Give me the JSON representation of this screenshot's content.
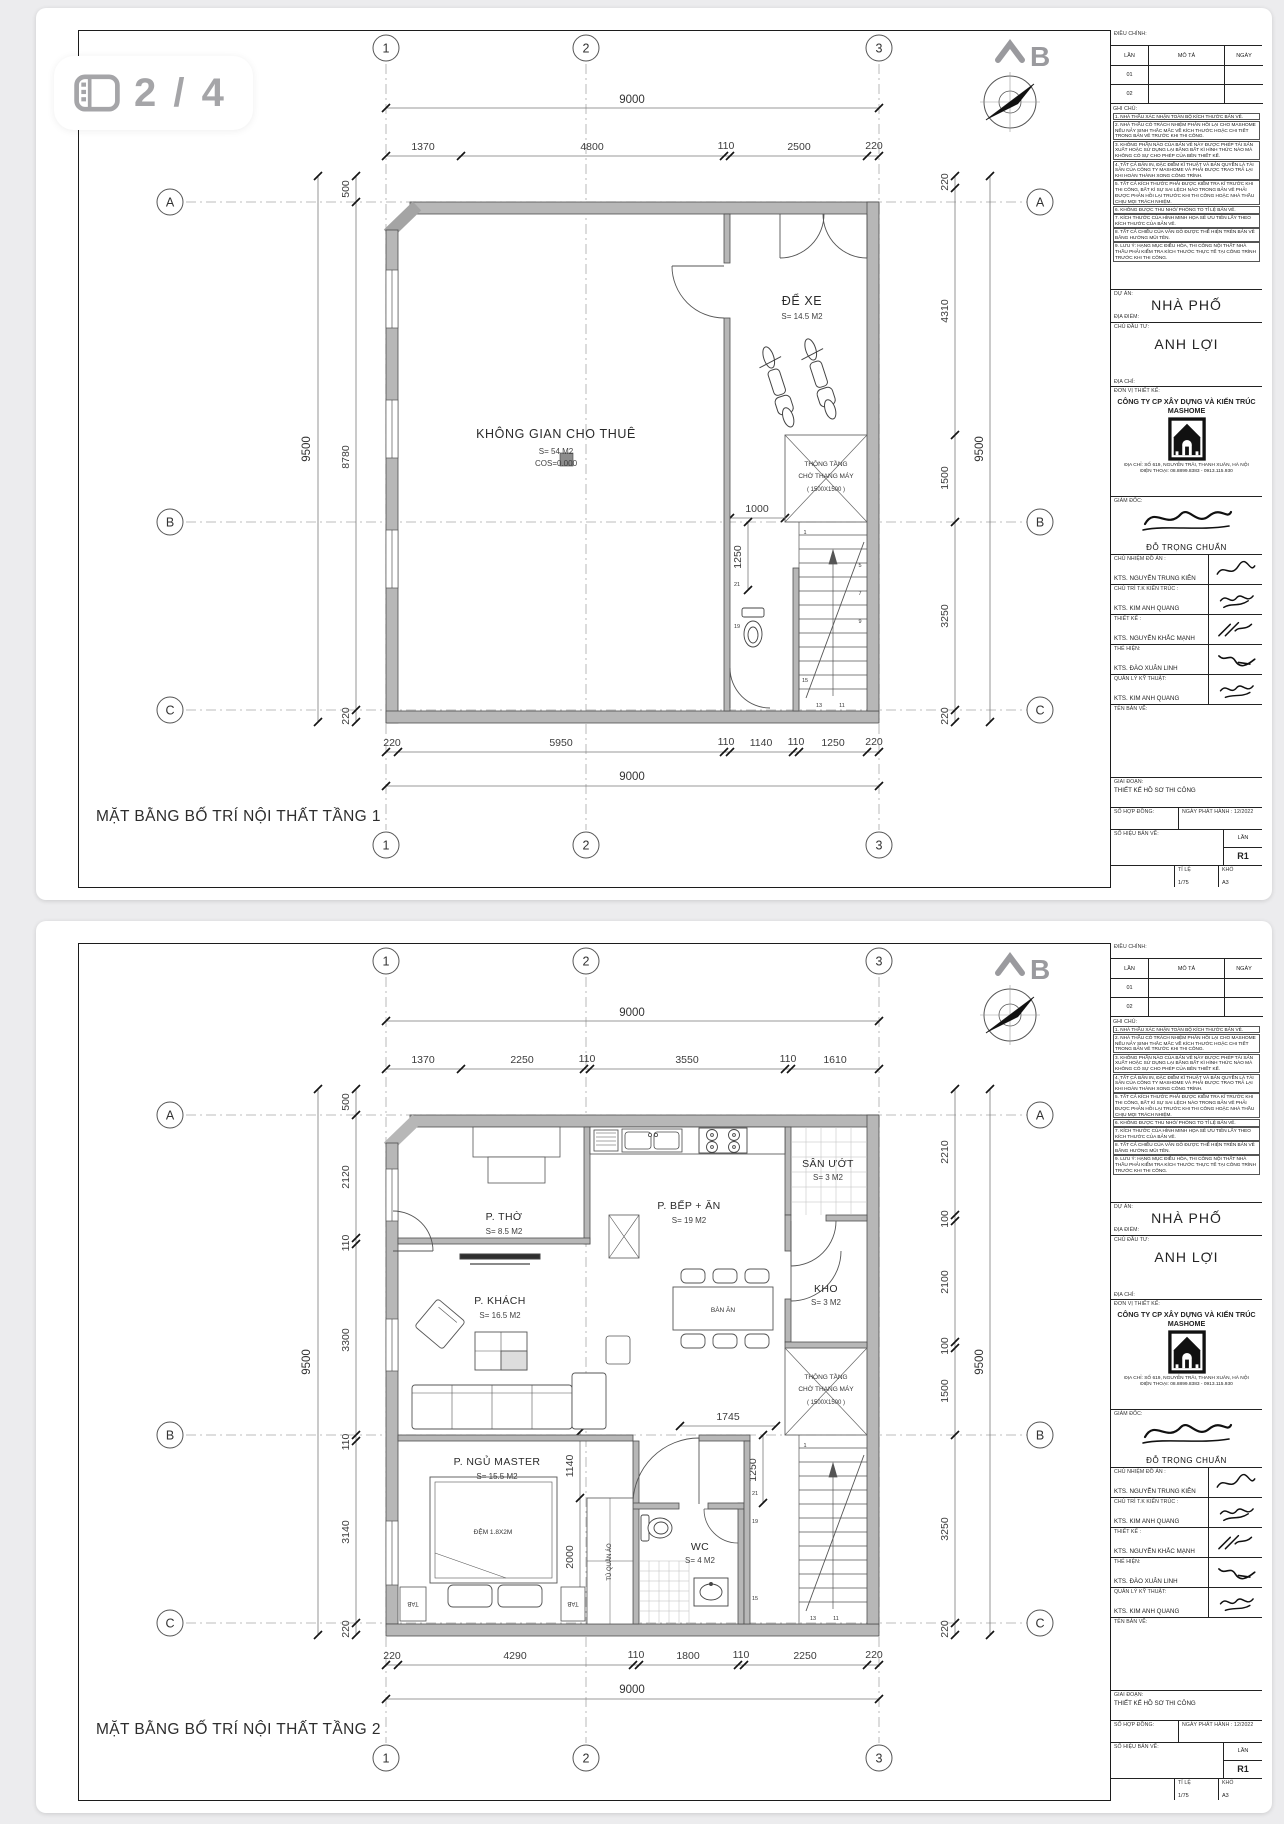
{
  "viewer": {
    "page_indicator": "2 / 4"
  },
  "compass": {
    "label": "B"
  },
  "grid": {
    "cols": [
      "1",
      "2",
      "3"
    ],
    "rows": [
      "A",
      "B",
      "C"
    ]
  },
  "title_block": {
    "revision": {
      "header": "ĐIỀU CHỈNH:",
      "columns": [
        "LẦN",
        "MÔ TẢ",
        "NGÀY"
      ],
      "rows": [
        "01",
        "02"
      ]
    },
    "notes": {
      "header": "GHI CHÚ:",
      "items": [
        "1. NHÀ THẦU XÁC NHẬN TOÀN BỘ KÍCH THƯỚC BẢN VẼ.",
        "2. NHÀ THẦU CÓ TRÁCH NHIỆM PHẢN HỒI LẠI CHO MASHOME NẾU NẢY SINH THẮC MẮC VỀ KÍCH THƯỚC HOẶC CHI TIẾT TRONG BẢN VẼ TRƯỚC KHI THI CÔNG.",
        "3. KHÔNG PHẦN NÀO CỦA BẢN VẼ NÀY ĐƯỢC PHÉP TÁI SẢN XUẤT HOẶC SỬ DỤNG LẠI BẰNG BẤT KÌ HÌNH THỨC NÀO MÀ KHÔNG CÓ SỰ CHO PHÉP CỦA BÊN THIẾT KẾ.",
        "4. TẤT CẢ BẢN IN, ĐẶC ĐIỂM KĨ THUẬT VÀ BẢN QUYỀN LÀ TÀI SẢN CỦA CÔNG TY MASHOME VÀ PHẢI ĐƯỢC TRAO TRẢ LẠI KHI HOÀN THÀNH XONG CÔNG TRÌNH.",
        "5. TẤT CẢ KÍCH THƯỚC PHẢI ĐƯỢC KIỂM TRA KĨ TRƯỚC KHI THI CÔNG, BẤT KÌ SỰ SAI LỆCH NÀO TRONG BẢN VẼ PHẢI ĐƯỢC PHẢN HỒI LẠI TRƯỚC KHI THI CÔNG HOẶC NHÀ THẦU CHỊU MỌI TRÁCH NHIỆM.",
        "6. KHÔNG ĐƯỢC THU NHỎ/ PHÓNG TO TỈ LỆ BẢN VẼ.",
        "7. KÍCH THƯỚC CỦA HÌNH MINH HỌA SẼ ƯU TIÊN LẤY THEO KÍCH THƯỚC CỦA BẢN VẼ.",
        "8. TẤT CẢ CHIỀU CỦA VÂN GỖ ĐƯỢC THỂ HIỆN TRÊN BẢN VẼ BẰNG HƯỚNG MŨI TÊN.",
        "9. LƯU Ý: HẠNG MỤC ĐIỀU HÒA, THI CÔNG NỘI THẤT NHÀ THẦU PHẢI KIỂM TRA KÍCH THƯỚC THỰC TẾ TẠI CÔNG TRÌNH TRƯỚC KHI THI CÔNG."
      ]
    },
    "project": {
      "label": "DỰ ÁN:",
      "value": "NHÀ PHỐ",
      "location_label": "ĐỊA ĐIỂM:"
    },
    "client": {
      "label": "CHỦ ĐẦU TƯ:",
      "value": "ANH LỢI",
      "address_label": "ĐỊA CHỈ:"
    },
    "designer": {
      "label": "ĐƠN VỊ THIẾT KẾ:",
      "company": "CÔNG TY CP XÂY DỰNG VÀ KIẾN TRÚC MASHOME",
      "address": "ĐỊA CHỈ:  SỐ 619, NGUYỄN TRÃI, THANH XUÂN, HÀ NỘI",
      "phone": "ĐIỆN THOẠI: 08.8899.8383 - 0913.115.930"
    },
    "director": {
      "label": "GIÁM ĐỐC:",
      "name": "ĐỖ TRỌNG CHUẨN"
    },
    "staff": [
      {
        "role": "CHỦ NHIỆM ĐỒ ÁN :",
        "name": "KTS. NGUYỄN TRUNG KIÊN"
      },
      {
        "role": "CHỦ TRÌ  T.K KIẾN TRÚC :",
        "name": "KTS. KIM ANH QUANG"
      },
      {
        "role": "THIẾT KẾ :",
        "name": "KTS. NGUYỄN KHẮC MẠNH"
      },
      {
        "role": "THỂ HIỆN:",
        "name": "KTS. ĐÀO XUÂN LINH"
      },
      {
        "role": "QUẢN LÝ KỸ THUẬT:",
        "name": "KTS. KIM ANH QUANG"
      }
    ],
    "drawing_name_label": "TÊN BẢN VẼ:",
    "stage": {
      "label": "GIAI ĐOẠN:",
      "value": "THIẾT KẾ HỒ SƠ THI CÔNG"
    },
    "contract": {
      "label": "SỐ HỢP ĐỒNG:",
      "issue": "NGÀY PHÁT HÀNH : 12/2022"
    },
    "drawing_no": {
      "label": "SỐ HIỆU BẢN VẼ:",
      "rev_label": "LẦN",
      "rev": "R1"
    },
    "scale": {
      "label": "TỈ LỆ",
      "value": "1/75",
      "size_label": "KHỔ",
      "size": "A3"
    }
  },
  "pages": [
    {
      "plan_title": "MẶT BẰNG BỐ TRÍ NỘI THẤT TẦNG 1",
      "dims": {
        "top_total": "9000",
        "top": [
          "1370",
          "4800",
          "110",
          "2500",
          "220"
        ],
        "left_total": "9500",
        "left": [
          "500",
          "8780",
          "220"
        ],
        "right": [
          "220",
          "4310",
          "1500",
          "3250",
          "220"
        ],
        "right_total": "9500",
        "bottom": [
          "220",
          "5950",
          "110",
          "1140",
          "110",
          "1250",
          "220"
        ],
        "bottom_total": "9000",
        "inner": [
          "1000",
          "1250"
        ]
      },
      "rooms": {
        "main": {
          "name": "KHÔNG GIAN CHO THUÊ",
          "area": "S= 54 M2",
          "level": "COS=0.000"
        },
        "parking": {
          "name": "ĐỂ XE",
          "area": "S= 14.5 M2"
        },
        "void": {
          "line1": "THÔNG TẦNG",
          "line2": "CHỜ THANG MÁY",
          "line3": "( 1500X1500 )"
        }
      },
      "stairs": [
        "1",
        "5",
        "7",
        "9",
        "11",
        "13",
        "15",
        "19",
        "21"
      ]
    },
    {
      "plan_title": "MẶT BẰNG BỐ TRÍ NỘI THẤT TẦNG 2",
      "dims": {
        "top_total": "9000",
        "top": [
          "1370",
          "2250",
          "110",
          "3550",
          "110",
          "1610"
        ],
        "left_total": "9500",
        "left": [
          "500",
          "2120",
          "110",
          "3300",
          "110",
          "3140",
          "220"
        ],
        "right": [
          "2210",
          "100",
          "2100",
          "100",
          "1500",
          "3250",
          "220"
        ],
        "right_total": "9500",
        "bottom": [
          "220",
          "4290",
          "110",
          "1800",
          "110",
          "2250",
          "220"
        ],
        "bottom_total": "9000",
        "inner": [
          "1745",
          "1250",
          "1140",
          "2000"
        ]
      },
      "rooms": {
        "tho": {
          "name": "P. THỜ",
          "area": "S= 8.5 M2"
        },
        "bep": {
          "name": "P. BẾP + ĂN",
          "area": "S= 19 M2"
        },
        "san_uot": {
          "name": "SÂN ƯỚT",
          "area": "S= 3 M2"
        },
        "kho": {
          "name": "KHO",
          "area": "S= 3 M2"
        },
        "ban_an": "BÀN ĂN",
        "khach": {
          "name": "P. KHÁCH",
          "area": "S= 16.5 M2"
        },
        "ngu": {
          "name": "P. NGỦ MASTER",
          "area": "S= 15.5 M2"
        },
        "dem": "ĐỆM 1.8X2M",
        "tab": "TAB",
        "tu_quan_ao": "TỦ QUẦN ÁO",
        "wc": {
          "name": "WC",
          "area": "S= 4 M2"
        },
        "void": {
          "line1": "THÔNG TẦNG",
          "line2": "CHỜ THANG MÁY",
          "line3": "( 1500X1500 )"
        }
      },
      "stairs": [
        "1",
        "11",
        "13",
        "15",
        "19",
        "21"
      ]
    }
  ]
}
